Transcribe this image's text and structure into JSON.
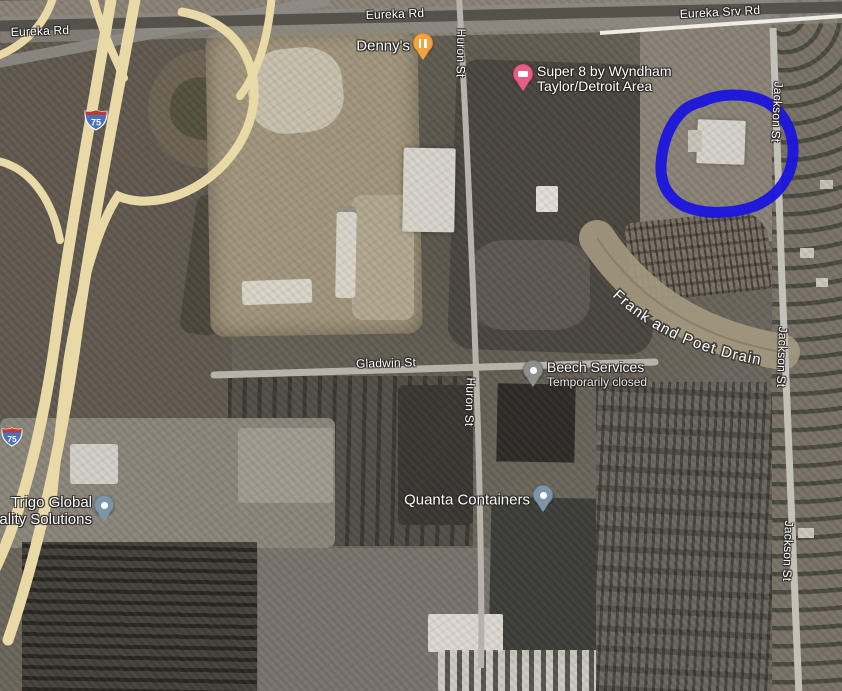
{
  "map": {
    "road_labels": [
      {
        "id": "eureka-rd-west",
        "text": "Eureka Rd"
      },
      {
        "id": "eureka-rd-center",
        "text": "Eureka Rd"
      },
      {
        "id": "eureka-srv-rd",
        "text": "Eureka Srv Rd"
      },
      {
        "id": "huron-st-north",
        "text": "Huron St"
      },
      {
        "id": "huron-st-south",
        "text": "Huron St"
      },
      {
        "id": "jackson-st-north",
        "text": "Jackson St"
      },
      {
        "id": "jackson-st-mid",
        "text": "Jackson St"
      },
      {
        "id": "jackson-st-south",
        "text": "Jackson St"
      },
      {
        "id": "gladwin-st",
        "text": "Gladwin St"
      }
    ],
    "waterway_label": "Frank and Poet Drain",
    "highway_shields": [
      {
        "number": "75"
      },
      {
        "number": "75"
      }
    ],
    "pois": [
      {
        "id": "dennys",
        "name": "Denny's",
        "category": "restaurant",
        "pin_color": "#F2A33C"
      },
      {
        "id": "super8",
        "name_line1": "Super 8 by Wyndham",
        "name_line2": "Taylor/Detroit Area",
        "category": "hotel",
        "pin_color": "#E85D86"
      },
      {
        "id": "beech-services",
        "name": "Beech Services",
        "status": "Temporarily closed",
        "pin_color": "#8E8E8E"
      },
      {
        "id": "quanta-containers",
        "name": "Quanta Containers",
        "pin_color": "#7E95A8"
      },
      {
        "id": "trigo",
        "name_line1": "Trigo Global",
        "name_line2": "uality Solutions",
        "pin_color": "#7E95A8"
      }
    ],
    "annotation": {
      "shape": "hand-drawn-ellipse",
      "color": "#1A14DE"
    },
    "colors": {
      "freeway": "#E8D9A6",
      "local_road": "#B9B5AD",
      "major_road": "#55524C",
      "drain_swath": "#A4997F"
    }
  }
}
